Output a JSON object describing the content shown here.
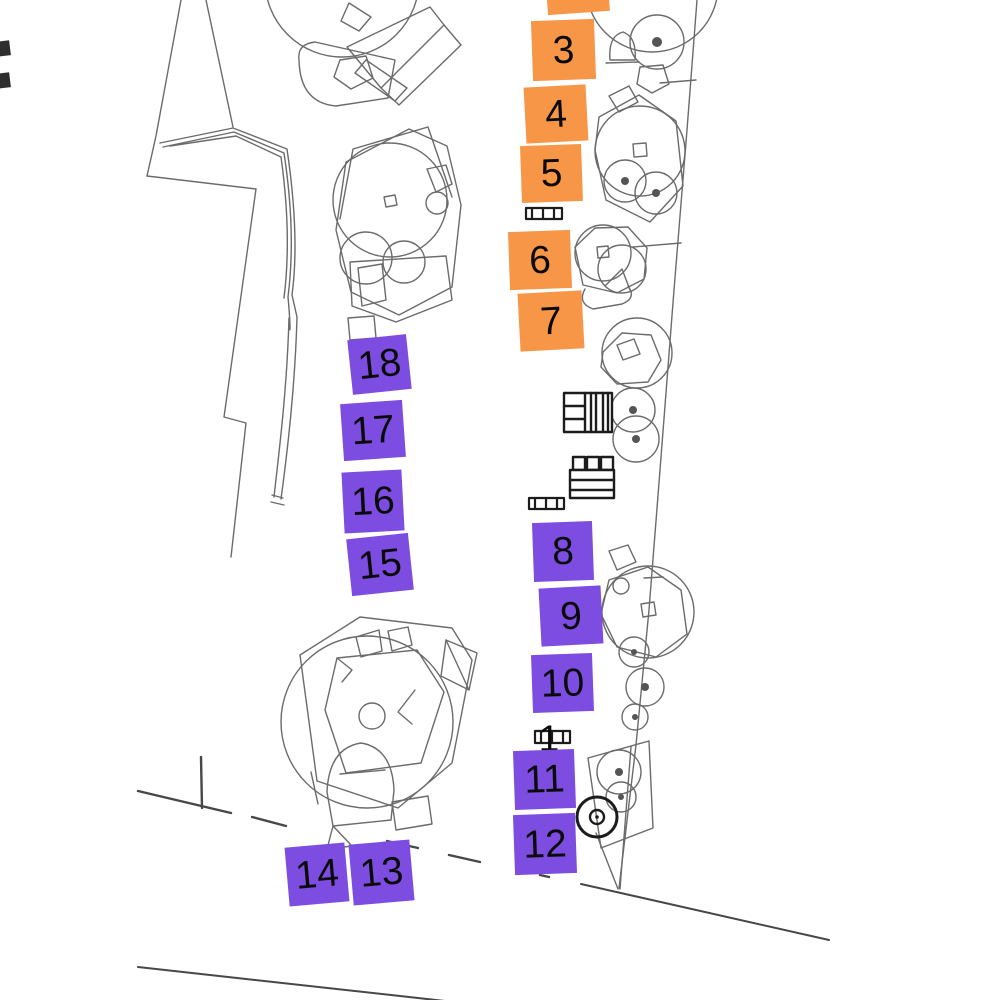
{
  "map": {
    "kind": "site-plan",
    "colors": {
      "orange": "#F79646",
      "purple": "#7C4DE0",
      "line": "#6b6b6b",
      "bold_line": "#1c1c1c",
      "label_text": "#0a0a0a",
      "background": "#ffffff"
    },
    "markers": [
      {
        "label": "",
        "type": "orange",
        "x": 546,
        "y": -44,
        "w": 62,
        "h": 57,
        "rot": -4
      },
      {
        "label": "3",
        "type": "orange",
        "x": 532,
        "y": 20,
        "w": 63,
        "h": 60,
        "rot": -2
      },
      {
        "label": "4",
        "type": "orange",
        "x": 525,
        "y": 86,
        "w": 62,
        "h": 56,
        "rot": -3
      },
      {
        "label": "5",
        "type": "orange",
        "x": 521,
        "y": 145,
        "w": 61,
        "h": 57,
        "rot": -2
      },
      {
        "label": "6",
        "type": "orange",
        "x": 509,
        "y": 231,
        "w": 62,
        "h": 58,
        "rot": -2
      },
      {
        "label": "7",
        "type": "orange",
        "x": 519,
        "y": 292,
        "w": 64,
        "h": 58,
        "rot": -3
      },
      {
        "label": "18",
        "type": "purple",
        "x": 350,
        "y": 337,
        "w": 59,
        "h": 55,
        "rot": -6
      },
      {
        "label": "17",
        "type": "purple",
        "x": 342,
        "y": 402,
        "w": 62,
        "h": 57,
        "rot": -4
      },
      {
        "label": "16",
        "type": "purple",
        "x": 343,
        "y": 471,
        "w": 60,
        "h": 61,
        "rot": -3
      },
      {
        "label": "15",
        "type": "purple",
        "x": 349,
        "y": 536,
        "w": 62,
        "h": 57,
        "rot": -6
      },
      {
        "label": "8",
        "type": "purple",
        "x": 533,
        "y": 522,
        "w": 60,
        "h": 59,
        "rot": -2
      },
      {
        "label": "9",
        "type": "purple",
        "x": 540,
        "y": 587,
        "w": 62,
        "h": 58,
        "rot": -3
      },
      {
        "label": "10",
        "type": "purple",
        "x": 532,
        "y": 654,
        "w": 61,
        "h": 58,
        "rot": -2
      },
      {
        "label": "1",
        "type": "plain",
        "x": 531,
        "y": 716,
        "w": 36,
        "h": 44,
        "rot": 0
      },
      {
        "label": "11",
        "type": "purple",
        "x": 514,
        "y": 750,
        "w": 61,
        "h": 59,
        "rot": -2
      },
      {
        "label": "12",
        "type": "purple",
        "x": 514,
        "y": 814,
        "w": 62,
        "h": 60,
        "rot": -2
      },
      {
        "label": "14",
        "type": "purple",
        "x": 287,
        "y": 845,
        "w": 60,
        "h": 59,
        "rot": -5
      },
      {
        "label": "13",
        "type": "purple",
        "x": 351,
        "y": 842,
        "w": 61,
        "h": 61,
        "rot": -5
      }
    ]
  }
}
